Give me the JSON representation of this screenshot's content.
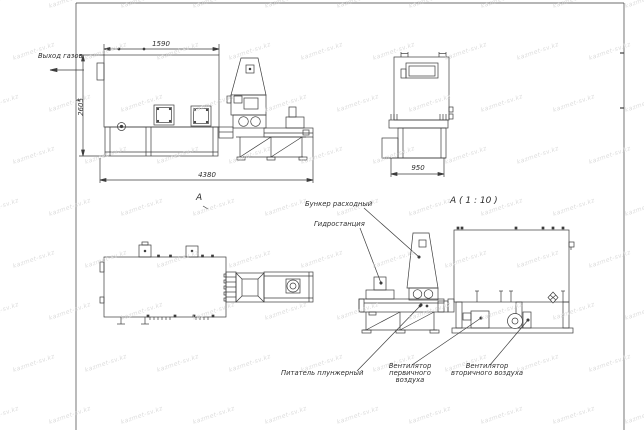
{
  "page": {
    "background": "#ffffff"
  },
  "colors": {
    "line": "#3d3d3d",
    "text": "#2f2f2f",
    "watermark": "#d6d6d6"
  },
  "watermark": {
    "text": "kazmet-sv.kz"
  },
  "views": {
    "side": {
      "gas_outlet_label": "Выход газов",
      "dim_top": "1590",
      "dim_left": "2605",
      "dim_bottom": "4380"
    },
    "end": {
      "dim_bottom": "950"
    },
    "plan": {
      "label": "А"
    },
    "detail": {
      "label": "А ( 1 : 10 )"
    }
  },
  "callouts": {
    "hopper": "Бункер расходный",
    "hydraulic_station": "Гидростанция",
    "plunger_feeder": "Питатель плунжерный",
    "primary_fan_line1": "Вентилятор",
    "primary_fan_line2": "первичного воздуха",
    "secondary_fan_line1": "Вентилятор",
    "secondary_fan_line2": "вторичного воздуха"
  }
}
